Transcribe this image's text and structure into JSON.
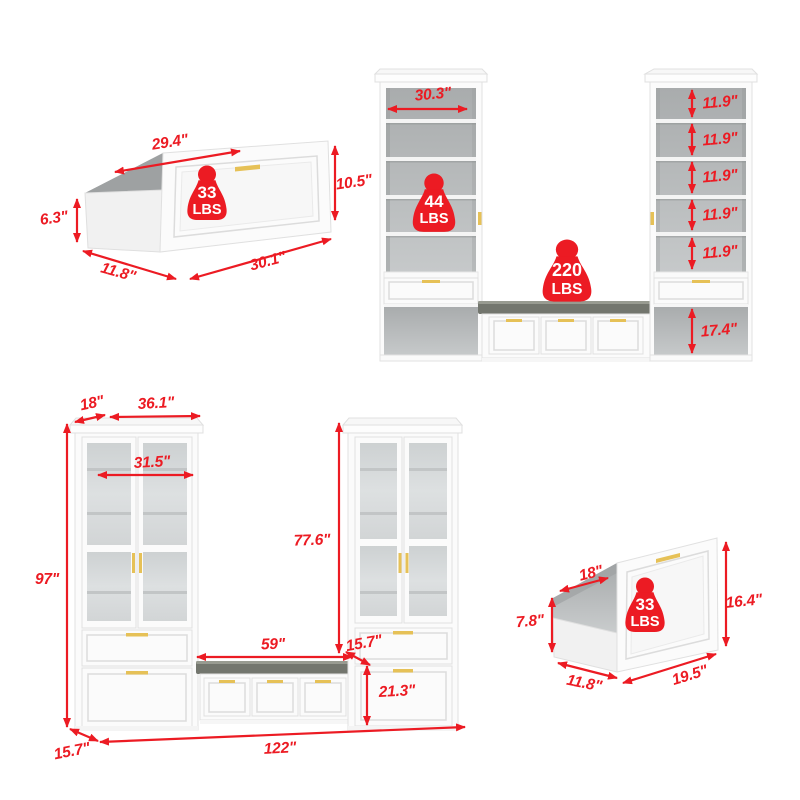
{
  "colors": {
    "dimension_red": "#EC1B23",
    "handle_gold": "#E6C157",
    "cabinet_white": "#fbfbfb",
    "interior_gray": "#b3b6b7",
    "cushion_gray": "#73766e"
  },
  "weight_badges": {
    "drawer_top": {
      "value": "33",
      "unit": "LBS"
    },
    "shelf": {
      "value": "44",
      "unit": "LBS"
    },
    "bench": {
      "value": "220",
      "unit": "LBS"
    },
    "drawer_bottom": {
      "value": "33",
      "unit": "LBS"
    }
  },
  "drawer_top_left": {
    "top_width": "29.4\"",
    "front_height": "10.5\"",
    "side_height": "6.3\"",
    "depth": "11.8\"",
    "front_width": "30.1\""
  },
  "wall_unit_open": {
    "inner_width": "30.3\"",
    "shelf_heights": [
      "11.9\"",
      "11.9\"",
      "11.9\"",
      "11.9\"",
      "11.9\""
    ],
    "base_height": "17.4\""
  },
  "wall_unit_full": {
    "crown_depth": "18\"",
    "tower_width": "36.1\"",
    "inner_width": "31.5\"",
    "total_height": "97\"",
    "tower_body_height": "77.6\"",
    "bench_width": "59\"",
    "bench_depth": "15.7\"",
    "bench_height": "21.3\"",
    "total_width": "122\"",
    "unit_depth": "15.7\""
  },
  "drawer_bottom_right": {
    "top_width": "18\"",
    "side_height": "7.8\"",
    "front_height": "16.4\"",
    "depth": "11.8\"",
    "front_width": "19.5\""
  }
}
